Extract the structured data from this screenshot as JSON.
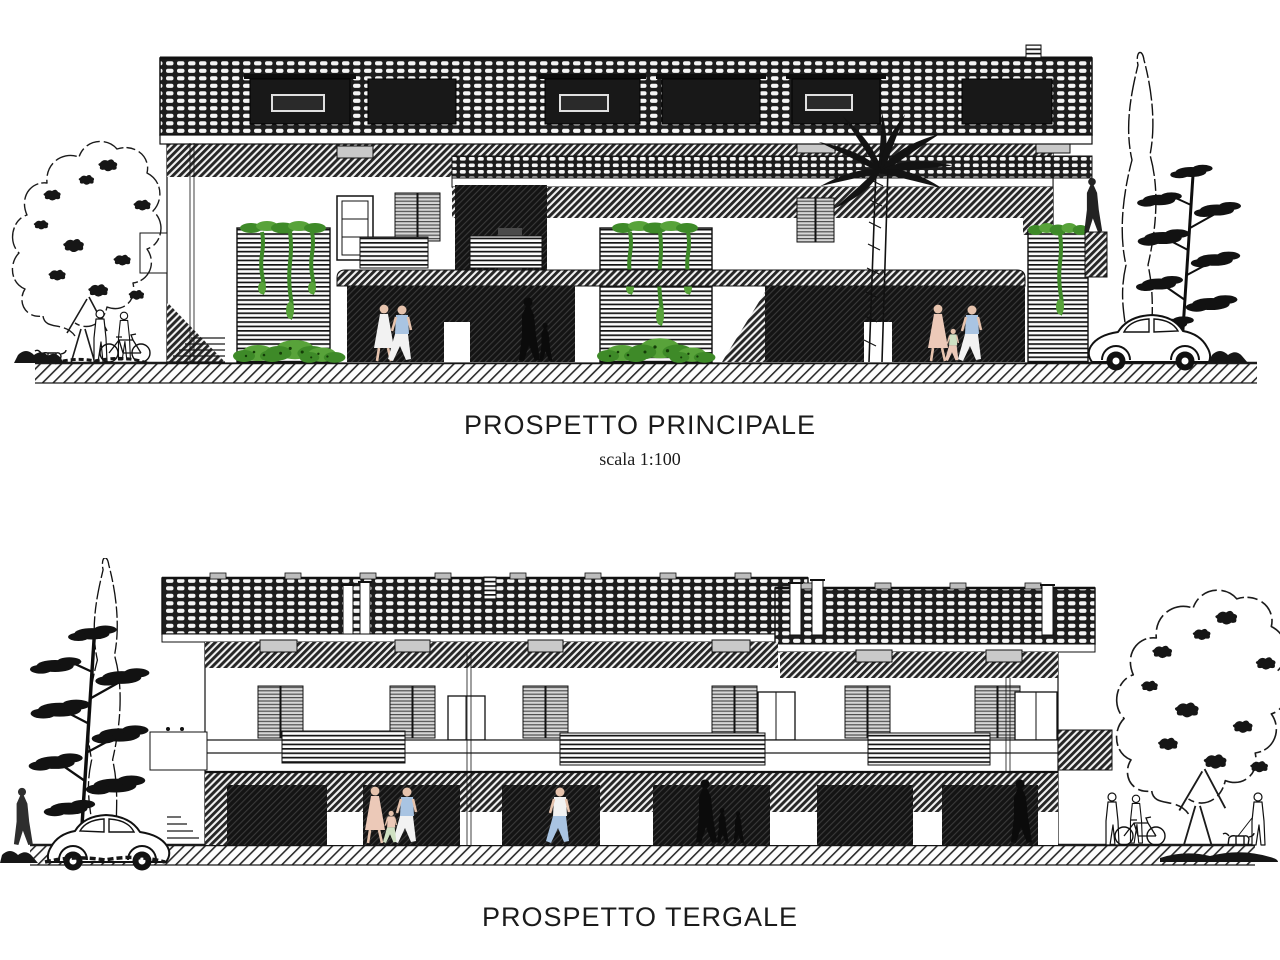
{
  "page": {
    "background": "#ffffff"
  },
  "drawings": [
    {
      "title": "PROSPETTO PRINCIPALE",
      "scale_note": "scala 1:100"
    },
    {
      "title": "PROSPETTO TERGALE"
    }
  ],
  "colors": {
    "ink": "#1b1b1b",
    "paper": "#ffffff",
    "shutter_gray": "#c9c9c9",
    "plant_green": "#58a33a",
    "plant_green_dark": "#3e8a28",
    "figure_skin": "#e6c3ad",
    "figure_blue": "#a9c4e2",
    "figure_peach": "#ecc9b8",
    "figure_white": "#f2f2f2"
  }
}
